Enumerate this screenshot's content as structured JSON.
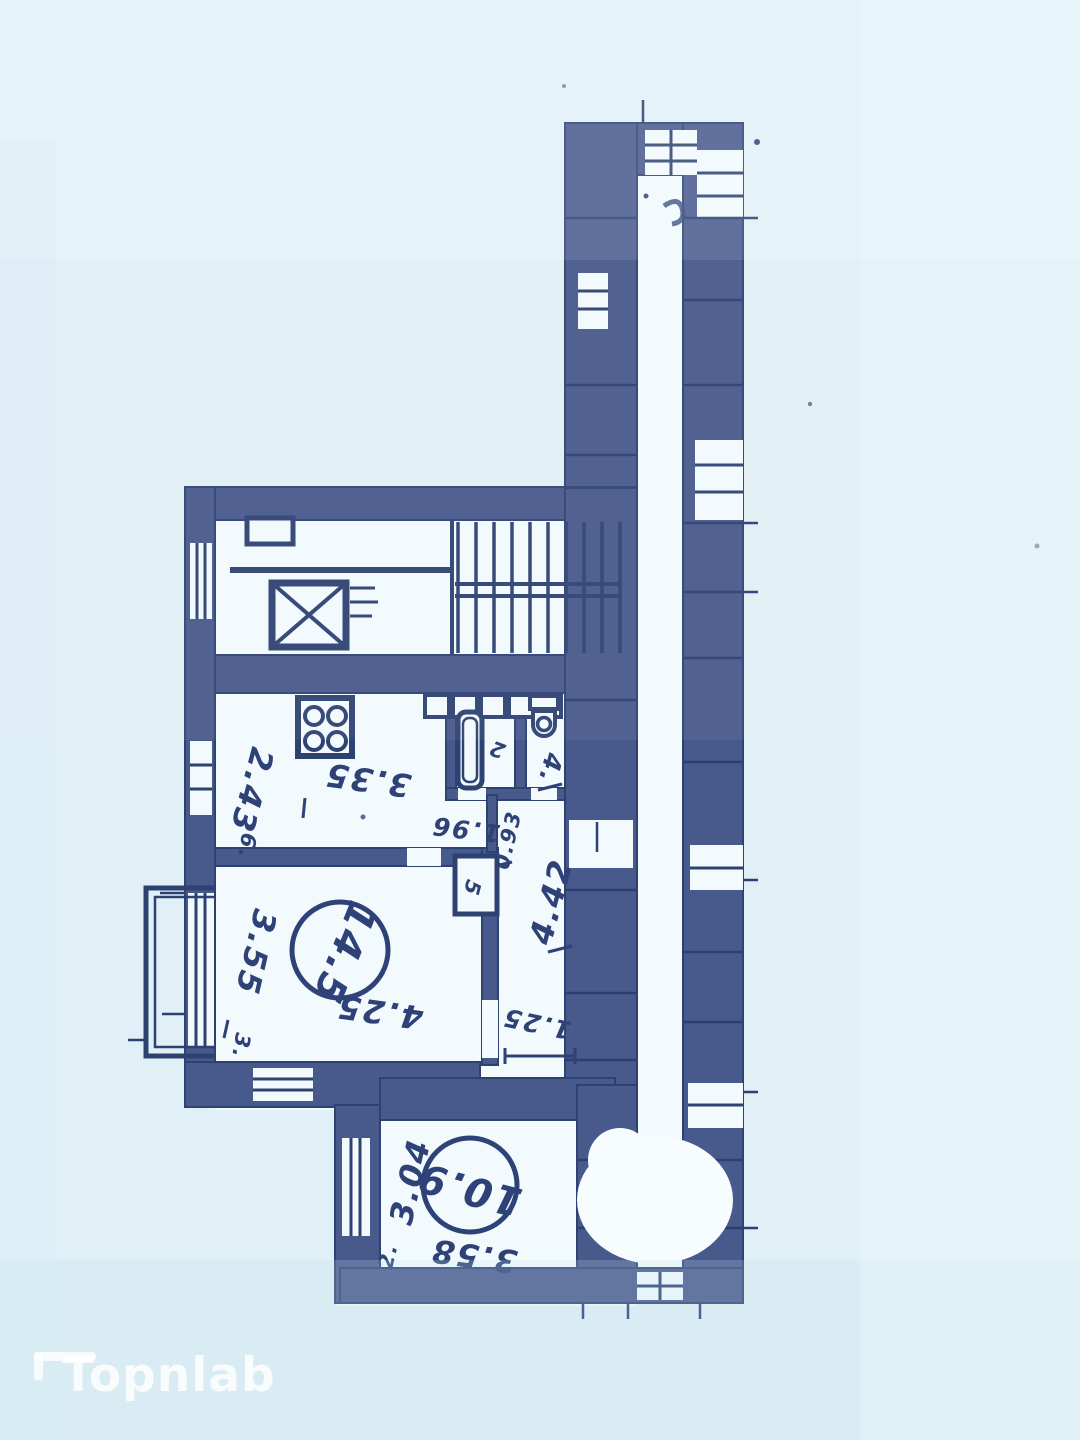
{
  "watermark": {
    "brand": "Topnlab"
  },
  "plan": {
    "room_areas": {
      "living": "14.5",
      "second": "10.9"
    },
    "dimensions": {
      "kitchen_width": "2.43",
      "kitchen_length": "3.35",
      "niche_depth": "1.96",
      "wc_width": "0.93",
      "hall_length": "4.42",
      "hall_width": "1.25",
      "living_width": "3.55",
      "living_length": "4.25",
      "second_width": "3.04",
      "second_length": "3.58"
    },
    "room_numbers": {
      "kitchen": "6.",
      "bath": "2",
      "wc": "4.",
      "closet": "5",
      "living": "3.",
      "second": "2."
    }
  }
}
